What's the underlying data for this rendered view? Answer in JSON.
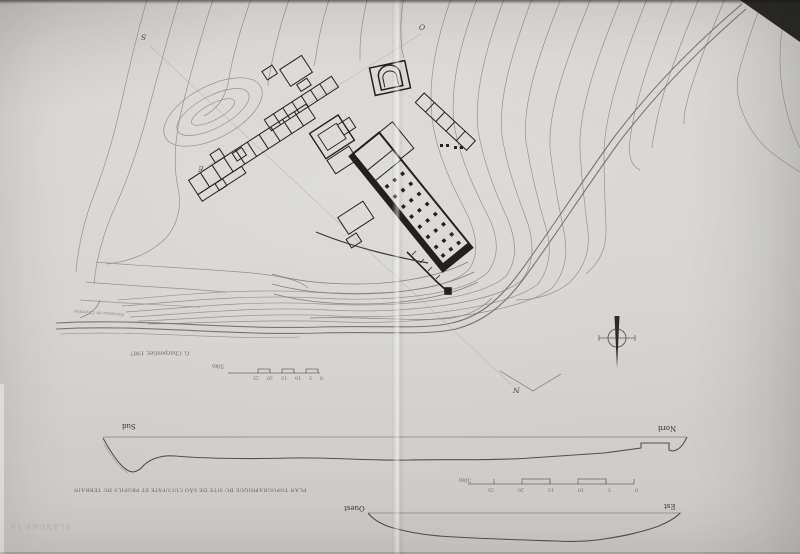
{
  "page": {
    "plate_label": "PLANCHE 19",
    "caption": "PLAN TOPOGRAPHIQUE DU SITE DE SÃO CUCUFATE ET PROFILS DU TERRAIN",
    "credit": "G. Charpentier, 1987",
    "paper_color": "#d4d2cf",
    "contour_ink": "#948e86",
    "building_ink": "#23211e",
    "caption_ink": "#5e6070"
  },
  "map": {
    "stream_label": "Ruisseau de Chaminé",
    "north_arrow_icon": "compass-needle",
    "cut_markers": {
      "sud": "S",
      "ouest": "O",
      "est": "E",
      "nord": "N"
    },
    "scale": {
      "ticks": [
        "0",
        "5",
        "10",
        "15",
        "20",
        "25"
      ],
      "total_label": "50m"
    }
  },
  "profiles": {
    "sud_nord": {
      "left_label": "Sud",
      "right_label": "Nord"
    },
    "ouest_est": {
      "left_label": "Ouest",
      "right_label": "Est"
    },
    "scale": {
      "ticks": [
        "0",
        "5",
        "10",
        "15",
        "20",
        "25"
      ],
      "total_label": "50m"
    }
  }
}
